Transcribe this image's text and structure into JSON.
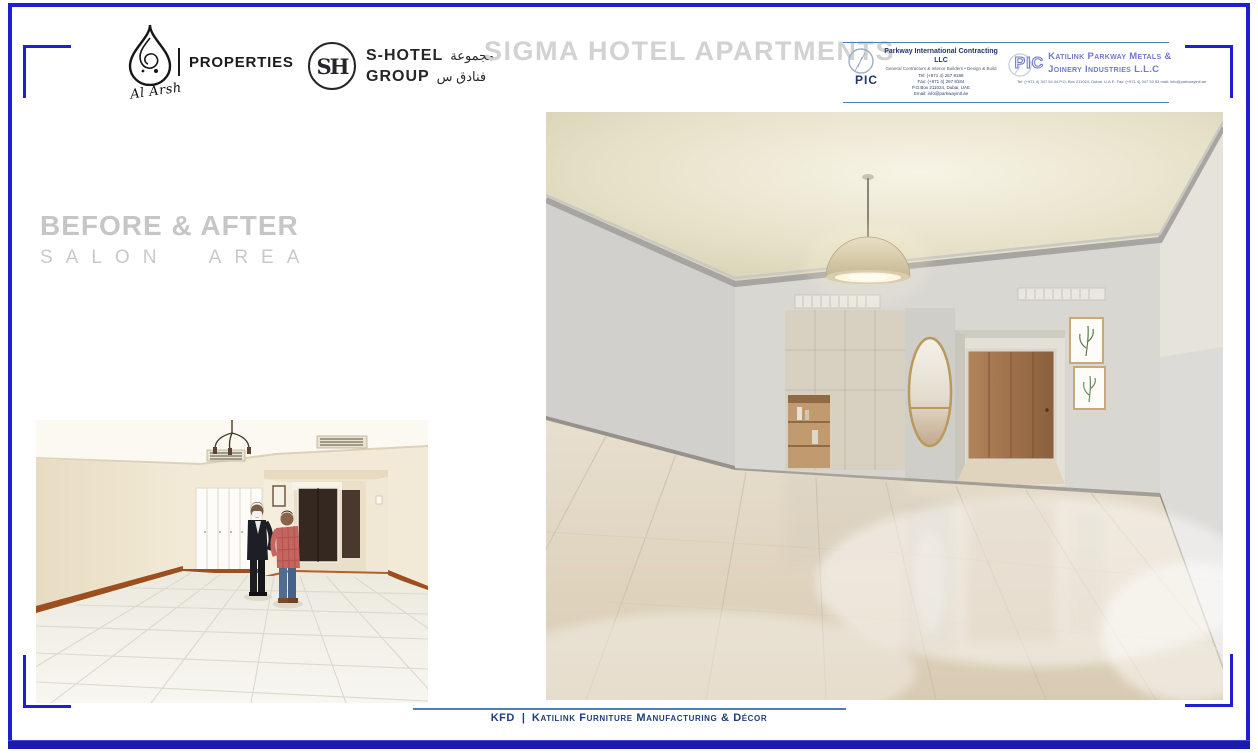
{
  "slide": {
    "title": "SIGMA HOTEL APARTMENTS",
    "section": {
      "heading": "BEFORE & AFTER",
      "subheading": "SALON AREA"
    }
  },
  "logos": {
    "al_arsh": {
      "name": "Al Arsh",
      "division": "PROPERTIES"
    },
    "s_hotel": {
      "monogram": "SH",
      "name_line1": "S-HOTEL",
      "name_line2": "GROUP",
      "arabic_line1": "مجموعة",
      "arabic_line2": "فنادق س"
    },
    "parkway": {
      "abbr": "PIC",
      "name": "Parkway International Contracting LLC",
      "tagline": "General Contractors & Interior Builders • Design & Build",
      "contact_lines": [
        "Tel: (+971 4) 267 8188",
        "Fax: (+971 4) 267 8184",
        "P.O.Box 211024, Dubai, UAE",
        "Email: info@parkwayintl.ae"
      ]
    },
    "katilink_pic": {
      "abbr": "PIC",
      "name_line1": "Katilink Parkway Metals &",
      "name_line2": "Joinery Industries L.L.C",
      "contact_line": "Tel: (+971 4) 347 54 44   P.O. Box 211024, Dubai, U.A.E.   Fax: (+971 4) 347 52 53   mail: info@parkwayintl.ae"
    }
  },
  "photos": {
    "before": {
      "alt": "Salon area before renovation — empty room with cream walls, white tiled floor, wooden skirting and two visitors talking"
    },
    "after": {
      "alt": "Salon area after renovation — rendered interior with grey walls, beige cabinetry, pendant dome light and glossy light-wood floor"
    }
  },
  "footer": {
    "brand": "KFD",
    "separator": "|",
    "text": "Katilink Furniture Manufacturing & Décor"
  },
  "colors": {
    "frame_blue": "#1e1ed2",
    "bottom_bar_blue": "#1b1bae",
    "rule_blue": "#4d7fb5",
    "title_gray": "#d2d2d2",
    "heading_gray": "#c6c6c6",
    "footer_navy": "#1e3e7c",
    "parkway_navy": "#22356e",
    "katilink_periwinkle": "#6f79cc"
  }
}
